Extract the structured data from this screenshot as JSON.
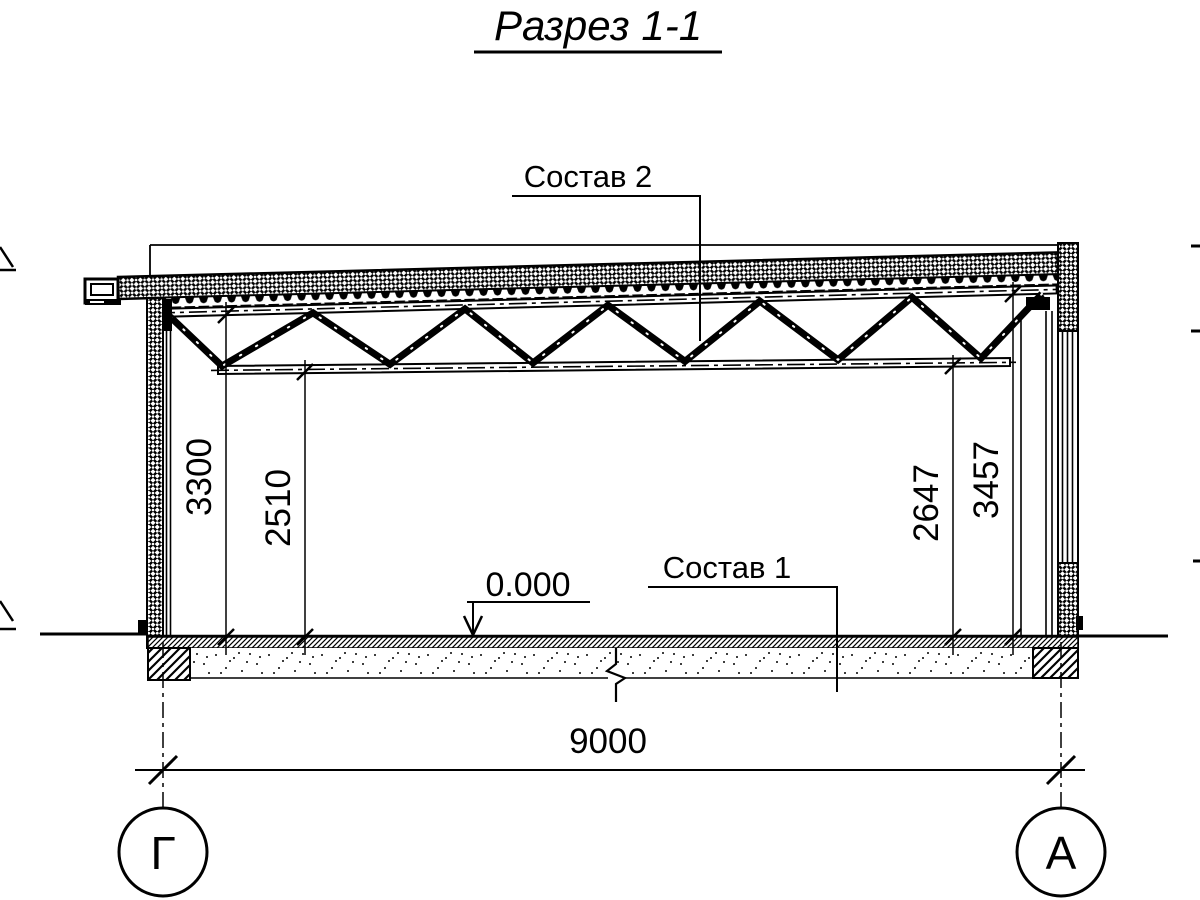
{
  "title": "Разрез 1-1",
  "labels": {
    "roof_composition": "Состав 2",
    "floor_composition": "Состав 1",
    "level_mark": "0.000"
  },
  "dimensions": {
    "left_outer": "3300",
    "left_inner": "2510",
    "right_inner": "2647",
    "right_outer": "3457",
    "span": "9000"
  },
  "axes": {
    "left": "Г",
    "right": "А"
  },
  "colors": {
    "line": "#000000",
    "background": "#ffffff"
  }
}
